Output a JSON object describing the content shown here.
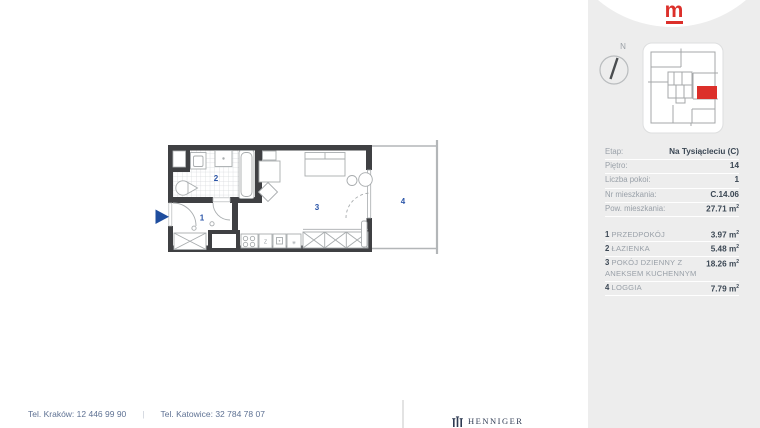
{
  "brand": {
    "letter": "m"
  },
  "compass": {
    "north_label": "N"
  },
  "units": {
    "base": "m",
    "exp": "2"
  },
  "sidebar": {
    "details": [
      {
        "label": "Etap:",
        "value": "Na Tysiącleciu (C)"
      },
      {
        "label": "Piętro:",
        "value": "14"
      },
      {
        "label": "Liczba pokoi:",
        "value": "1"
      },
      {
        "label": "Nr mieszkania:",
        "value": "C.14.06"
      },
      {
        "label": "Pow. mieszkania:",
        "value": "27.71"
      }
    ]
  },
  "rooms": [
    {
      "num": "1",
      "name": "PRZEDPOKÓJ",
      "area": "3.97"
    },
    {
      "num": "2",
      "name": "ŁAZIENKA",
      "area": "5.48"
    },
    {
      "num": "3",
      "name": "POKÓJ DZIENNY Z ANEKSEM KUCHENNYM",
      "area": "18.26"
    },
    {
      "num": "4",
      "name": "LOGGIA",
      "area": "7.79"
    }
  ],
  "floorplan": {
    "labels": [
      "1",
      "2",
      "3",
      "4"
    ],
    "kitchen": {
      "sink_label": "Z",
      "vent_symbol": "✳"
    }
  },
  "footer": {
    "phone_krakow": "Tel. Kraków: 12 446 99 90",
    "divider": "|",
    "phone_katowice": "Tel. Katowice: 32 784 78 07",
    "partner": "HENNIGER"
  },
  "colors": {
    "accent_red": "#dc2f2a",
    "accent_blue": "#2b55a8",
    "wall": "#3f4043",
    "sidebar_bg": "#ededed",
    "unit_highlight": "#dc2f2a"
  }
}
